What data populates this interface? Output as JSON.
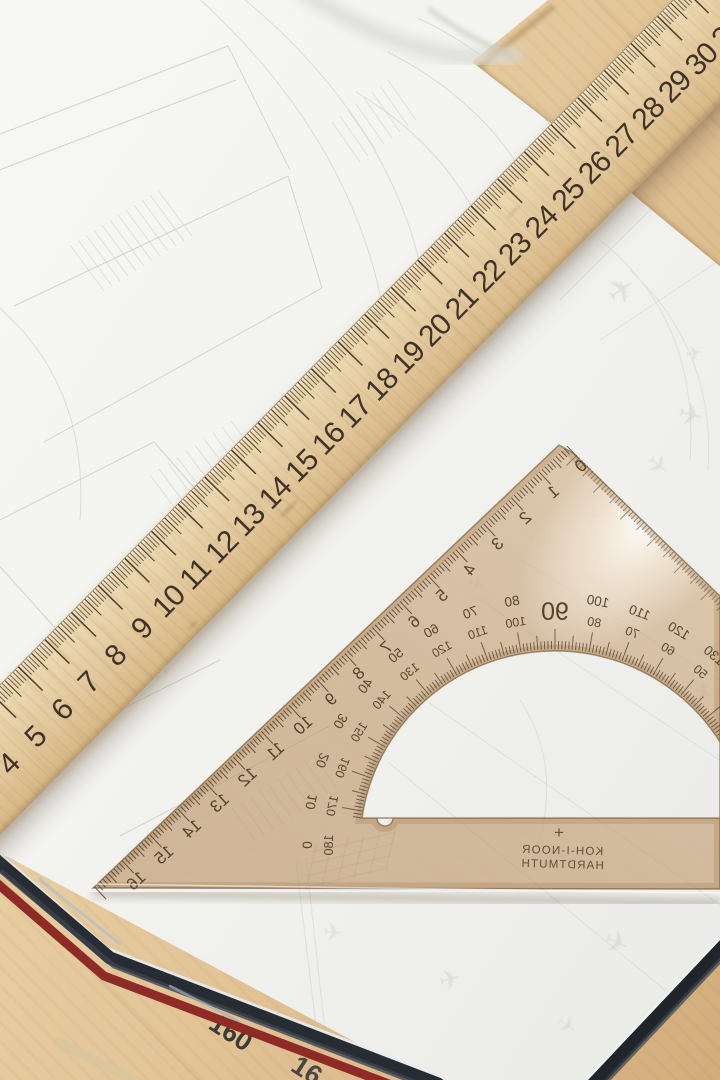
{
  "photo": {
    "description": "Wooden ruler and transparent set square protractor lying on architectural sketches",
    "colors": {
      "desk_wood": "#e4c99c",
      "paper": "#f5f5f2",
      "sketch_line": "#c6cac6",
      "ruler_wood": "#e8d2a9",
      "ruler_marks": "#3f3327",
      "set_square_tint": "#c79e6c",
      "set_square_marks": "#4a3626",
      "book_edge_dark": "#23282e",
      "book_edge_stripe_red": "#8f2b26",
      "page_number_color": "#3a3a3a"
    },
    "ruler": {
      "numbers": [
        "3",
        "4",
        "5",
        "6",
        "7",
        "8",
        "9",
        "10",
        "11",
        "12",
        "13",
        "14",
        "15",
        "16",
        "17",
        "18",
        "19",
        "20",
        "21",
        "22",
        "23",
        "24",
        "25",
        "26",
        "27",
        "28",
        "29",
        "30",
        "31",
        "32"
      ]
    },
    "set_square": {
      "brand_line1": "KOH-I-NOOR",
      "brand_line2": "HARDTMUTH",
      "plus_mark": "+",
      "edge_numbers": [
        "0",
        "1",
        "2",
        "3",
        "4",
        "5",
        "6",
        "7",
        "8",
        "9",
        "10",
        "11",
        "12",
        "13",
        "14",
        "15",
        "16"
      ],
      "protractor_center_label": "90",
      "protractor_pairs": [
        {
          "outer": "0",
          "inner": "180"
        },
        {
          "outer": "10",
          "inner": "170"
        },
        {
          "outer": "20",
          "inner": "160"
        },
        {
          "outer": "30",
          "inner": "150"
        },
        {
          "outer": "40",
          "inner": "140"
        },
        {
          "outer": "50",
          "inner": "130"
        },
        {
          "outer": "60",
          "inner": "120"
        },
        {
          "outer": "70",
          "inner": "110"
        },
        {
          "outer": "80",
          "inner": "100"
        },
        {
          "outer": "100",
          "inner": "80"
        },
        {
          "outer": "110",
          "inner": "70"
        },
        {
          "outer": "120",
          "inner": "60"
        },
        {
          "outer": "130",
          "inner": "50"
        },
        {
          "outer": "140",
          "inner": "40"
        }
      ]
    },
    "book": {
      "page_number": "160",
      "page_number_partial": "16"
    },
    "sketch_plane_glyph": "✈"
  }
}
